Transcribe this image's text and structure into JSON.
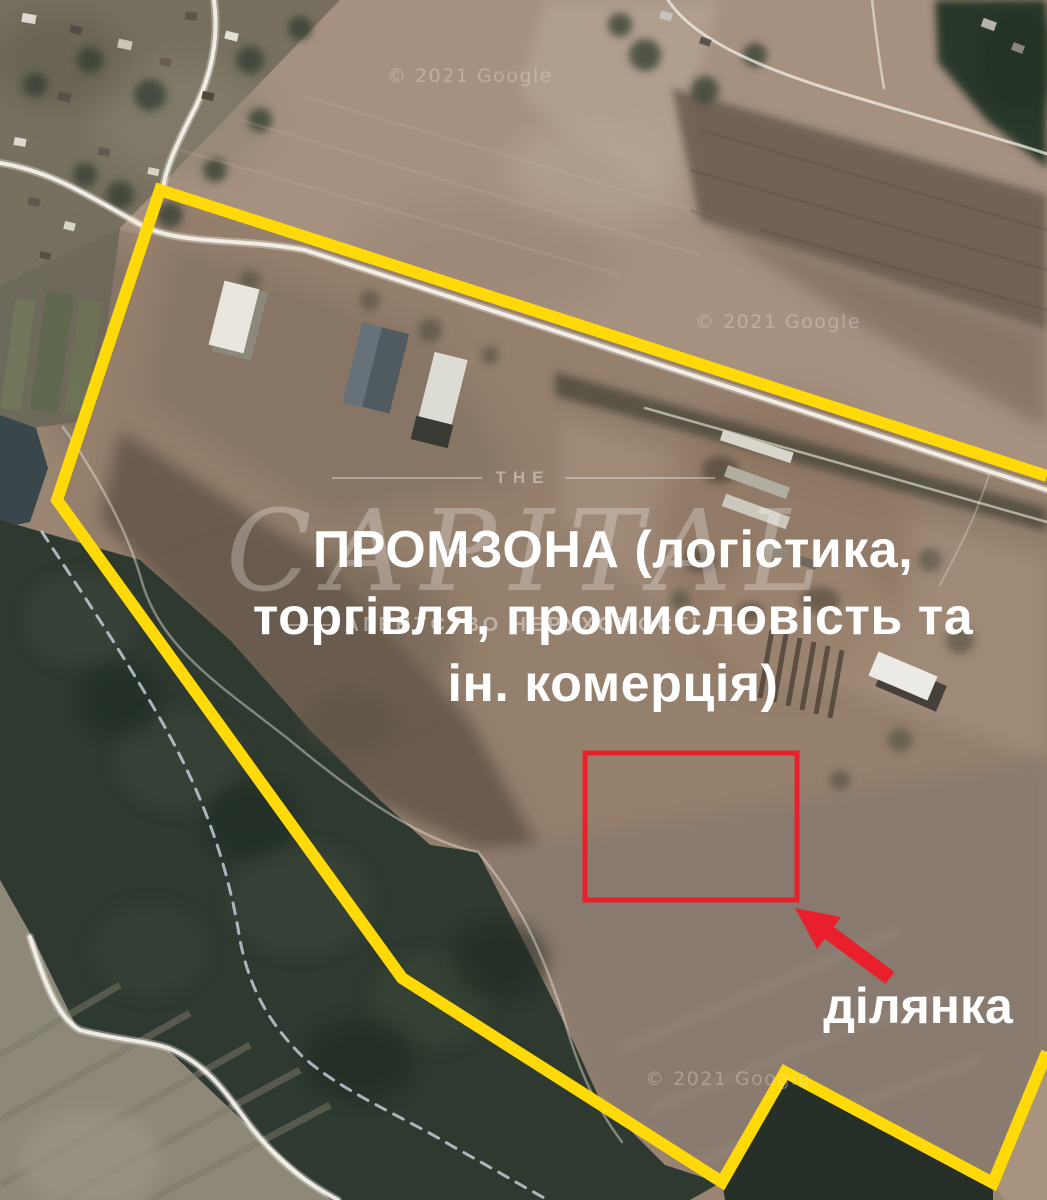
{
  "map_annotations": {
    "zone_label_lines": [
      "ПРОМЗОНА (логістика,",
      "торгівля, промисловість та",
      "ін. комерція)"
    ],
    "plot_label": "ділянка",
    "zone_outline_color": "#ffd908",
    "plot_outline_color": "#e9202b",
    "annotation_text_color": "#ffffff"
  },
  "watermark": {
    "brand_top": "THE",
    "brand_main": "CAPITAL",
    "brand_subtitle": "АГЕНТСТВО НЕРУХОМОСТІ"
  },
  "attribution": {
    "instances": [
      "© 2021 Google",
      "© 2021 Google",
      "© 2021 Google"
    ]
  }
}
